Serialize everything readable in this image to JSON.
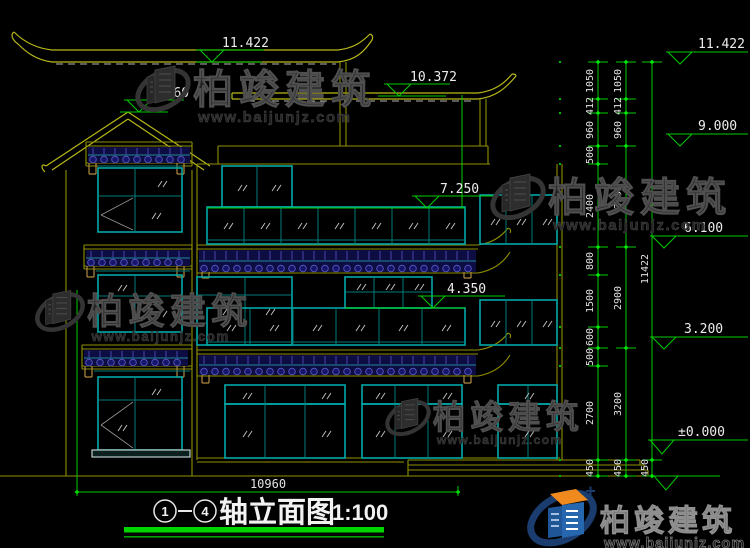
{
  "colors": {
    "background": "#000000",
    "linework_yellow": "#8f8f00",
    "window_teal": "#00a8a8",
    "dimension_green": "#00cc00",
    "tile_blue": "#0d0d44",
    "logo_blue": "#2767b0",
    "logo_orange": "#f08a1e"
  },
  "watermark": {
    "brand": "柏竣建筑",
    "url": "www.baijunjz.com"
  },
  "title_block": {
    "axis_start": "1",
    "axis_end": "4",
    "name": "轴立面图",
    "scale": "1:100"
  },
  "levels": {
    "left": [
      "11.422",
      "9.960",
      "10.372",
      "7.250",
      "4.350"
    ],
    "right": [
      "11.422",
      "9.000",
      "6.100",
      "3.200",
      "±0.000"
    ]
  },
  "dims": {
    "total_width": "10960",
    "total_height": "11422",
    "col_inner": [
      "1050",
      "412",
      "960",
      "500",
      "2400",
      "800",
      "1500",
      "600",
      "500",
      "2700"
    ],
    "col_middle": [
      "1050",
      "412",
      "960",
      "2900",
      "2900",
      "3200"
    ],
    "below_ground": [
      "450",
      "450",
      "450"
    ]
  }
}
